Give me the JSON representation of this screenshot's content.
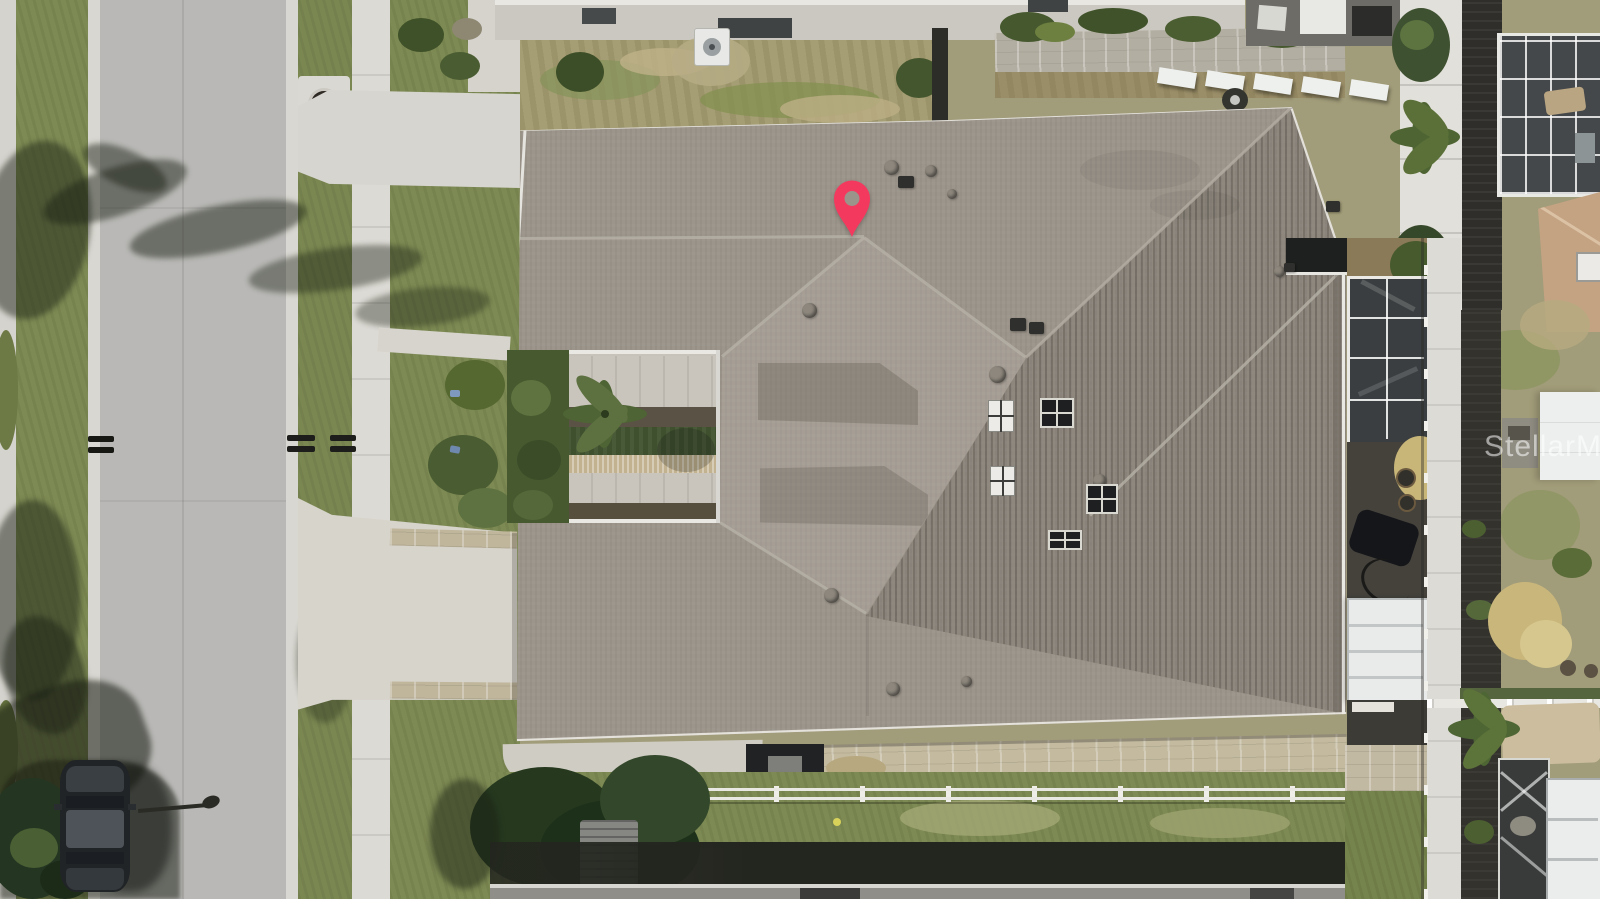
{
  "meta": {
    "kind": "aerial-drone-photo",
    "description": "Top-down aerial photo of a single-family home with gray shingle roof, front courtyard, street at left, neighboring homes, pool screen enclosures and a red listing location pin",
    "width_px": 1600,
    "height_px": 899
  },
  "watermark": {
    "text": "StellarMLS",
    "color": "rgba(255,255,255,0.55)"
  },
  "map_pin": {
    "label": "property-location-pin",
    "color": "#f4395f",
    "hole_color": "#9a948b",
    "tip_x": 852,
    "tip_y": 237
  },
  "palette": {
    "road": "#b9b8b6",
    "concrete": "#d8d6d0",
    "grass": "#7d8a53",
    "scrub": "#a19c79",
    "roof_main": "#9c958b",
    "roof_stripe_shade": "#7e776d",
    "eave_white": "#eae8e2",
    "pool_screen": "#3a3e40",
    "pergola_white": "#e9ebeb",
    "tan_pavers": "#c3ba9f",
    "neighbor_roof": "#8f8e89",
    "shadow_band": "#23251f",
    "car_body": "#212427",
    "tan_roof_neighbor": "#c4a383",
    "hedge": "#3e502d"
  },
  "scene_objects": [
    "street",
    "sidewalks",
    "parkway-grass",
    "storm-drain",
    "mailboxes",
    "parked-car",
    "palm-tree-shadows",
    "main-house-roof",
    "front-courtyard-garden",
    "driveway",
    "roof-vents",
    "skylights",
    "pool-screen-enclosures",
    "white-pergolas",
    "rear-neighbor-house",
    "ac-unit",
    "white-fences",
    "bottom-neighbor-roof",
    "location-pin",
    "mls-watermark"
  ],
  "roof_fixtures": {
    "round_vents": [
      {
        "x": 884,
        "y": 160,
        "d": 15
      },
      {
        "x": 925,
        "y": 165,
        "d": 12
      },
      {
        "x": 947,
        "y": 189,
        "d": 10
      },
      {
        "x": 802,
        "y": 303,
        "d": 15
      },
      {
        "x": 989,
        "y": 366,
        "d": 17
      },
      {
        "x": 824,
        "y": 588,
        "d": 15
      },
      {
        "x": 1093,
        "y": 474,
        "d": 13
      },
      {
        "x": 886,
        "y": 682,
        "d": 14
      },
      {
        "x": 961,
        "y": 676,
        "d": 11
      },
      {
        "x": 1274,
        "y": 266,
        "d": 11
      }
    ],
    "dark_vents": [
      {
        "x": 898,
        "y": 176,
        "w": 16,
        "h": 12
      },
      {
        "x": 1010,
        "y": 318,
        "w": 16,
        "h": 13
      },
      {
        "x": 1029,
        "y": 322,
        "w": 15,
        "h": 12
      },
      {
        "x": 1326,
        "y": 201,
        "w": 14,
        "h": 11
      },
      {
        "x": 1284,
        "y": 263,
        "w": 11,
        "h": 9
      }
    ],
    "white_skylights": [
      {
        "x": 988,
        "y": 400,
        "w": 26,
        "h": 32
      },
      {
        "x": 990,
        "y": 466,
        "w": 25,
        "h": 30
      }
    ],
    "dark_skylights": [
      {
        "x": 1040,
        "y": 398,
        "w": 34,
        "h": 30
      },
      {
        "x": 1086,
        "y": 484,
        "w": 32,
        "h": 30
      },
      {
        "x": 1048,
        "y": 530,
        "w": 34,
        "h": 20
      }
    ]
  }
}
